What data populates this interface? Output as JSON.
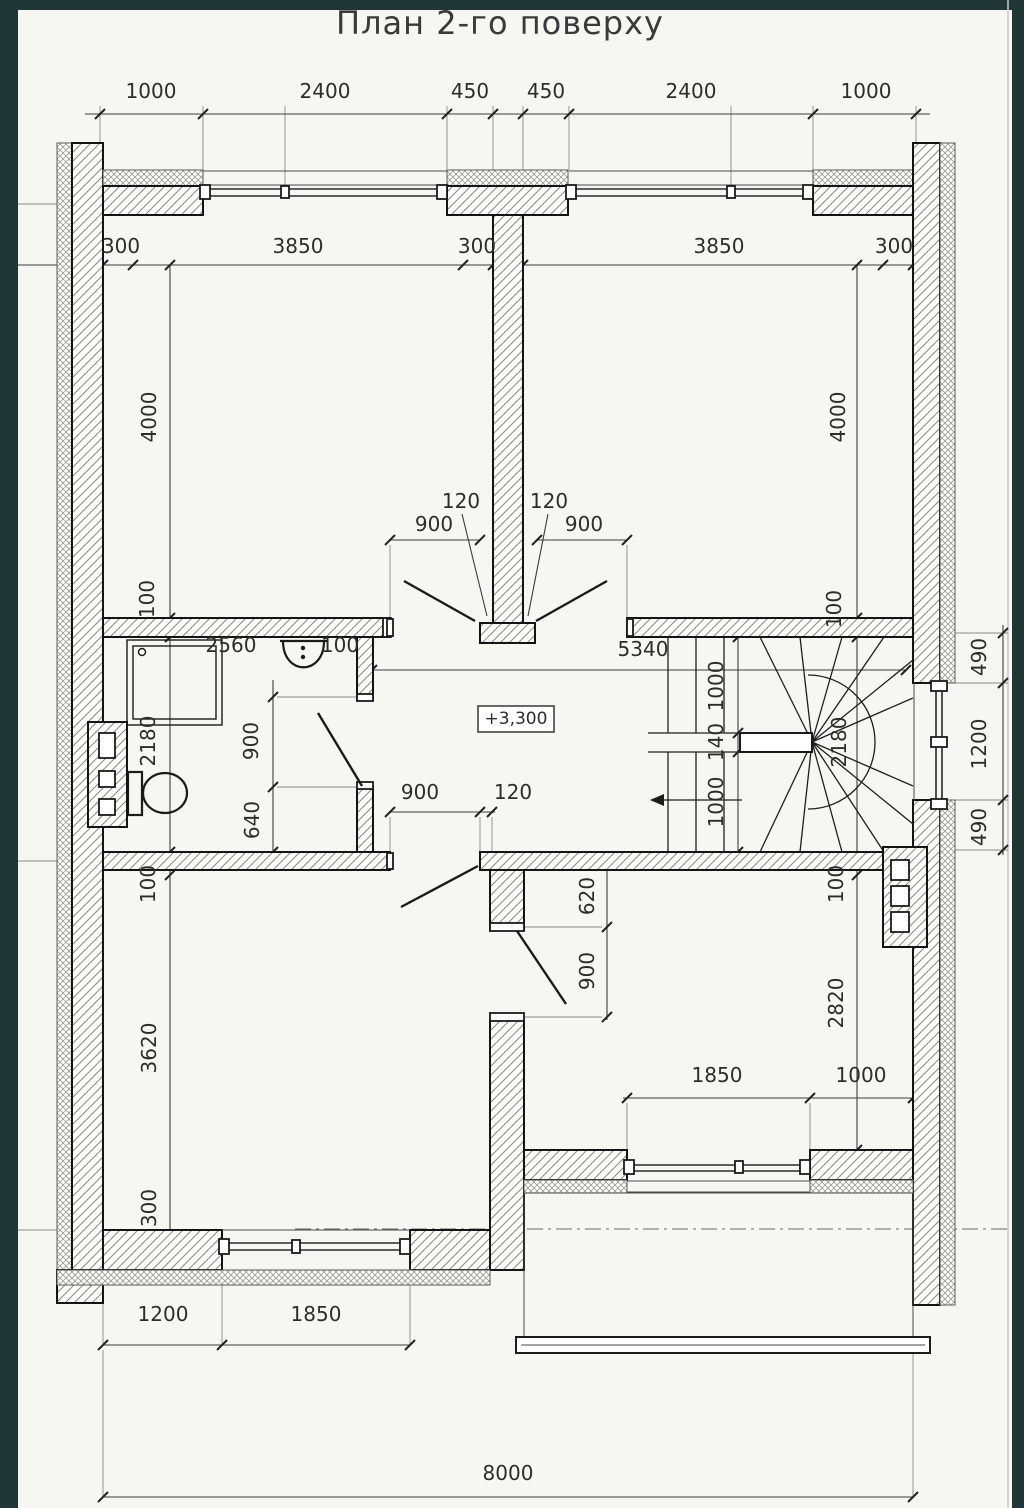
{
  "page": {
    "title": "План 2-го поверху",
    "frame_color": "#203637",
    "paper_color": "#f6f6f3",
    "ink_color": "#141414"
  },
  "plan": {
    "level_mark": "+3,300",
    "dimension_chains": {
      "top": [
        "1000",
        "2400",
        "450",
        "450",
        "2400",
        "1000"
      ],
      "upper_rooms_horizontal": [
        "300",
        "3850",
        "300",
        "3850",
        "300"
      ],
      "upper_rooms_vertical": [
        "4000",
        "100",
        "4000",
        "100"
      ],
      "bathroom": [
        "2560",
        "100",
        "2180",
        "900",
        "640"
      ],
      "hall_doors": [
        "120",
        "900",
        "120",
        "900"
      ],
      "hall_width": "5340",
      "stair": [
        "1000",
        "140",
        "1000",
        "2180"
      ],
      "right_window": [
        "490",
        "1200",
        "490"
      ],
      "lower_middle": [
        "900",
        "120",
        "620",
        "900"
      ],
      "lower_left_room": [
        "100",
        "3620",
        "300"
      ],
      "lower_right_room": [
        "100",
        "2820"
      ],
      "balcony_window": [
        "1850",
        "1000"
      ],
      "bottom_window": [
        "1200",
        "1850"
      ],
      "overall_width": "8000"
    },
    "annotations": [
      {
        "name": "dim-top-1000-left",
        "text": "1000",
        "x": 151,
        "y": 98,
        "rot": 0
      },
      {
        "name": "dim-top-2400-left",
        "text": "2400",
        "x": 325,
        "y": 98,
        "rot": 0
      },
      {
        "name": "dim-top-450-left",
        "text": "450",
        "x": 470,
        "y": 98,
        "rot": 0
      },
      {
        "name": "dim-top-450-right",
        "text": "450",
        "x": 546,
        "y": 98,
        "rot": 0
      },
      {
        "name": "dim-top-2400-right",
        "text": "2400",
        "x": 691,
        "y": 98,
        "rot": 0
      },
      {
        "name": "dim-top-1000-right",
        "text": "1000",
        "x": 866,
        "y": 98,
        "rot": 0
      },
      {
        "name": "dim-room-300-l1",
        "text": "300",
        "x": 121,
        "y": 253,
        "rot": 0
      },
      {
        "name": "dim-room-3850-left",
        "text": "3850",
        "x": 298,
        "y": 253,
        "rot": 0
      },
      {
        "name": "dim-room-300-l2",
        "text": "300",
        "x": 477,
        "y": 253,
        "rot": 0
      },
      {
        "name": "dim-room-3850-right",
        "text": "3850",
        "x": 719,
        "y": 253,
        "rot": 0
      },
      {
        "name": "dim-room-300-r2",
        "text": "300",
        "x": 894,
        "y": 253,
        "rot": 0
      },
      {
        "name": "dim-room-4000-left",
        "text": "4000",
        "x": 156,
        "y": 417,
        "rot": -90
      },
      {
        "name": "dim-wall-100-left",
        "text": "100",
        "x": 154,
        "y": 599,
        "rot": -90
      },
      {
        "name": "dim-room-4000-right",
        "text": "4000",
        "x": 845,
        "y": 417,
        "rot": -90
      },
      {
        "name": "dim-wall-100-right",
        "text": "100",
        "x": 841,
        "y": 609,
        "rot": -90
      },
      {
        "name": "dim-bath-2560",
        "text": "2560",
        "x": 231,
        "y": 652,
        "rot": 0
      },
      {
        "name": "dim-bath-100",
        "text": "100",
        "x": 340,
        "y": 652,
        "rot": 0
      },
      {
        "name": "dim-bath-2180",
        "text": "2180",
        "x": 155,
        "y": 741,
        "rot": -90
      },
      {
        "name": "dim-bath-900",
        "text": "900",
        "x": 258,
        "y": 741,
        "rot": -90
      },
      {
        "name": "dim-bath-640",
        "text": "259",
        "x": 259,
        "y": 820,
        "rot": -90
      },
      {
        "name": "dim-door-120-left",
        "text": "120",
        "x": 461,
        "y": 508,
        "rot": 0
      },
      {
        "name": "dim-door-900-left",
        "text": "900",
        "x": 434,
        "y": 531,
        "rot": 0
      },
      {
        "name": "dim-door-120-right",
        "text": "120",
        "x": 549,
        "y": 508,
        "rot": 0
      },
      {
        "name": "dim-door-900-right",
        "text": "900",
        "x": 584,
        "y": 531,
        "rot": 0
      },
      {
        "name": "dim-hall-5340",
        "text": "5340",
        "x": 643,
        "y": 656,
        "rot": 0
      },
      {
        "name": "dim-stair-1000-up",
        "text": "1000",
        "x": 723,
        "y": 686,
        "rot": -90
      },
      {
        "name": "dim-stair-140",
        "text": "140",
        "x": 723,
        "y": 742,
        "rot": -90
      },
      {
        "name": "dim-stair-1000-down",
        "text": "1000",
        "x": 723,
        "y": 802,
        "rot": -90
      },
      {
        "name": "dim-stair-2180",
        "text": "2180",
        "x": 846,
        "y": 742,
        "rot": -90
      },
      {
        "name": "dim-right-490-top",
        "text": "490",
        "x": 986,
        "y": 657,
        "rot": -90
      },
      {
        "name": "dim-right-1200",
        "text": "1200",
        "x": 986,
        "y": 744,
        "rot": -90
      },
      {
        "name": "dim-right-490-bottom",
        "text": "490",
        "x": 986,
        "y": 827,
        "rot": -90
      },
      {
        "name": "dim-lower-900-door",
        "text": "900",
        "x": 420,
        "y": 799,
        "rot": 0
      },
      {
        "name": "dim-lower-120",
        "text": "120",
        "x": 513,
        "y": 799,
        "rot": 0
      },
      {
        "name": "dim-lower-620",
        "text": "620",
        "x": 594,
        "y": 896,
        "rot": -90
      },
      {
        "name": "dim-lower-900",
        "text": "900",
        "x": 594,
        "y": 971,
        "rot": -90
      },
      {
        "name": "dim-lleft-100",
        "text": "100",
        "x": 155,
        "y": 884,
        "rot": -90
      },
      {
        "name": "dim-lleft-3620",
        "text": "3620",
        "x": 156,
        "y": 1048,
        "rot": -90
      },
      {
        "name": "dim-lleft-300",
        "text": "300",
        "x": 156,
        "y": 1208,
        "rot": -90
      },
      {
        "name": "dim-lright-100",
        "text": "100",
        "x": 843,
        "y": 884,
        "rot": -90
      },
      {
        "name": "dim-lright-2820",
        "text": "2820",
        "x": 843,
        "y": 1003,
        "rot": -90
      },
      {
        "name": "dim-balc-1850",
        "text": "1850",
        "x": 717,
        "y": 1082,
        "rot": 0
      },
      {
        "name": "dim-balc-1000",
        "text": "1000",
        "x": 861,
        "y": 1082,
        "rot": 0
      },
      {
        "name": "dim-bot-1200",
        "text": "1200",
        "x": 163,
        "y": 1321,
        "rot": 0
      },
      {
        "name": "dim-bot-1850",
        "text": "1850",
        "x": 316,
        "y": 1321,
        "rot": 0
      },
      {
        "name": "dim-overall-8000",
        "text": "8000",
        "x": 508,
        "y": 1480,
        "rot": 0
      },
      {
        "name": "level-mark",
        "text": "+3,300",
        "x": 516,
        "y": 724,
        "rot": 0,
        "cls": "level"
      }
    ]
  }
}
